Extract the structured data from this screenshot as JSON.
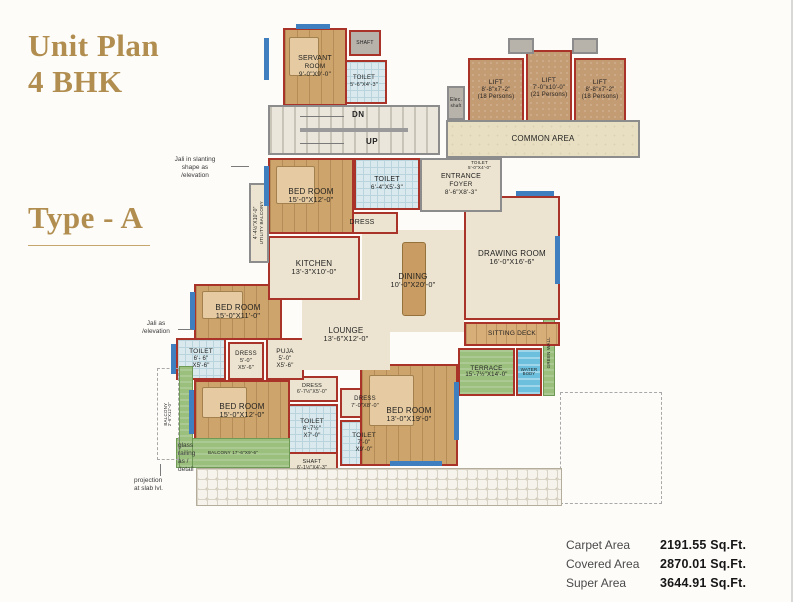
{
  "header": {
    "title_line1": "Unit Plan",
    "title_line2": "4 BHK",
    "type_label": "Type - A"
  },
  "stats": {
    "rows": [
      {
        "label": "Carpet Area",
        "value": "2191.55 Sq.Ft."
      },
      {
        "label": "Covered Area",
        "value": "2870.01 Sq.Ft."
      },
      {
        "label": "Super Area",
        "value": "3644.91 Sq.Ft."
      }
    ]
  },
  "colors": {
    "title_gold": "#b18e50",
    "wall_red": "#a93229",
    "wall_gray": "#8c8c8c",
    "window_blue": "#3f7fbf",
    "terrace_green": "#9bbf7d",
    "water_blue": "#6cc0dd"
  },
  "plan": {
    "stair_dn": "DN",
    "stair_up": "UP",
    "rooms": [
      {
        "id": "paver-strip",
        "x": 196,
        "y": 468,
        "w": 366,
        "h": 38,
        "fill": "paver",
        "border": "thin",
        "lines": []
      },
      {
        "id": "projection-dashed-outline",
        "x": 560,
        "y": 392,
        "w": 102,
        "h": 112,
        "fill": "none",
        "border": "dashed",
        "lines": []
      },
      {
        "id": "balcony-side",
        "x": 157,
        "y": 368,
        "w": 22,
        "h": 92,
        "fill": "none",
        "border": "dashed",
        "vertical": true,
        "size": 4.5,
        "lines": [
          "BALCONY",
          "2'-6\"X12'-0\""
        ]
      },
      {
        "id": "green-strip-left",
        "x": 179,
        "y": 366,
        "w": 14,
        "h": 102,
        "fill": "green",
        "border": "green",
        "lines": []
      },
      {
        "id": "balcony-bottom",
        "x": 176,
        "y": 438,
        "w": 114,
        "h": 30,
        "fill": "green",
        "border": "green",
        "size": 4.5,
        "lines": [
          "BALCONY 17'-6\"X9'-6\""
        ]
      },
      {
        "id": "stairs",
        "x": 268,
        "y": 105,
        "w": 172,
        "h": 50,
        "fill": "stair",
        "border": "gray",
        "deco": "stairs",
        "lines": []
      },
      {
        "id": "common-area",
        "x": 446,
        "y": 120,
        "w": 194,
        "h": 38,
        "fill": "common",
        "border": "gray",
        "size": 8,
        "lines": [
          "COMMON AREA"
        ]
      },
      {
        "id": "lift-shaft-a",
        "x": 508,
        "y": 38,
        "w": 26,
        "h": 16,
        "fill": "grayfill",
        "border": "gray",
        "lines": []
      },
      {
        "id": "lift-shaft-b",
        "x": 572,
        "y": 38,
        "w": 26,
        "h": 16,
        "fill": "grayfill",
        "border": "gray",
        "lines": []
      },
      {
        "id": "lift-1",
        "x": 468,
        "y": 58,
        "w": 56,
        "h": 64,
        "fill": "lift",
        "border": "red",
        "size": 6.5,
        "lines": [
          "LIFT",
          "8'-8\"x7'-2\"",
          "(18 Persons)"
        ]
      },
      {
        "id": "lift-2",
        "x": 526,
        "y": 50,
        "w": 46,
        "h": 76,
        "fill": "lift",
        "border": "red",
        "size": 6.5,
        "lines": [
          "LIFT",
          "7'-0\"x10'-0\"",
          "(21 Persons)"
        ]
      },
      {
        "id": "lift-3",
        "x": 574,
        "y": 58,
        "w": 52,
        "h": 64,
        "fill": "lift",
        "border": "red",
        "size": 6.5,
        "lines": [
          "LIFT",
          "8'-8\"x7'-2\"",
          "(18 Persons)"
        ]
      },
      {
        "id": "elec-shaft",
        "x": 447,
        "y": 86,
        "w": 18,
        "h": 34,
        "fill": "grayfill",
        "border": "gray",
        "size": 5,
        "lines": [
          "Elec.",
          "shaft"
        ]
      },
      {
        "id": "servant-room",
        "x": 283,
        "y": 28,
        "w": 64,
        "h": 78,
        "fill": "wood",
        "border": "red",
        "size": 7,
        "deco": "bed",
        "lines": [
          "SERVANT",
          "ROOM",
          "9'-0\"X9'-0\""
        ]
      },
      {
        "id": "servant-shaft",
        "x": 349,
        "y": 30,
        "w": 32,
        "h": 26,
        "fill": "grayfill",
        "border": "red",
        "size": 5,
        "lines": [
          "SHAFT"
        ]
      },
      {
        "id": "servant-toilet",
        "x": 341,
        "y": 60,
        "w": 46,
        "h": 44,
        "fill": "tile",
        "border": "red",
        "size": 6,
        "lines": [
          "TOILET",
          "5'-6\"X4'-3\""
        ]
      },
      {
        "id": "utility-balcony",
        "x": 249,
        "y": 183,
        "w": 20,
        "h": 80,
        "fill": "beige",
        "border": "gray",
        "vertical": true,
        "size": 5,
        "lines": [
          "4'-4½\"X10'-0\"",
          "UTILITY BALCONY"
        ]
      },
      {
        "id": "bedroom-1",
        "x": 268,
        "y": 158,
        "w": 86,
        "h": 76,
        "fill": "wood",
        "border": "red",
        "size": 8,
        "deco": "bed",
        "lines": [
          "BED ROOM",
          "15'-0\"X12'-0\""
        ]
      },
      {
        "id": "toilet-1",
        "x": 354,
        "y": 158,
        "w": 66,
        "h": 52,
        "fill": "tile",
        "border": "red",
        "size": 7,
        "lines": [
          "TOILET",
          "6'-4\"X5'-3\""
        ]
      },
      {
        "id": "dress-1",
        "x": 326,
        "y": 212,
        "w": 72,
        "h": 22,
        "fill": "beige",
        "border": "red",
        "size": 7,
        "lines": [
          "DRESS"
        ]
      },
      {
        "id": "kitchen",
        "x": 268,
        "y": 236,
        "w": 92,
        "h": 64,
        "fill": "beige",
        "border": "red",
        "size": 8,
        "lines": [
          "KITCHEN",
          "13'-3\"X10'-0\""
        ]
      },
      {
        "id": "entrance-foyer",
        "x": 420,
        "y": 158,
        "w": 82,
        "h": 54,
        "fill": "beige",
        "border": "gray",
        "size": 7,
        "lines": [
          "ENTRANCE",
          "FOYER",
          "8'-6\"X8'-3\""
        ]
      },
      {
        "id": "powder-toilet",
        "x": 457,
        "y": 152,
        "w": 45,
        "h": 26,
        "fill": "tile",
        "border": "red",
        "size": 4.5,
        "lines": [
          "TOILET 5'-0\"X4'-0\""
        ]
      },
      {
        "id": "dining",
        "x": 362,
        "y": 230,
        "w": 102,
        "h": 102,
        "fill": "beige",
        "border": "none",
        "size": 8,
        "deco": "table",
        "lines": [
          "DINING",
          "10'-0\"X20'-0\""
        ]
      },
      {
        "id": "drawing-room",
        "x": 464,
        "y": 196,
        "w": 96,
        "h": 124,
        "fill": "beige",
        "border": "red",
        "size": 8,
        "lines": [
          "DRAWING ROOM",
          "16'-0\"X16'-6\""
        ]
      },
      {
        "id": "lounge",
        "x": 302,
        "y": 300,
        "w": 88,
        "h": 70,
        "fill": "beige",
        "border": "none",
        "size": 8,
        "lines": [
          "LOUNGE",
          "13'-6\"X12'-0\""
        ]
      },
      {
        "id": "sitting-deck",
        "x": 464,
        "y": 322,
        "w": 96,
        "h": 24,
        "fill": "deck",
        "border": "red",
        "size": 6.5,
        "lines": [
          "SITTING DECK"
        ]
      },
      {
        "id": "terrace",
        "x": 458,
        "y": 348,
        "w": 57,
        "h": 48,
        "fill": "green",
        "border": "red",
        "size": 6.5,
        "lines": [
          "TERRACE",
          "15'-7½\"X14'-0\""
        ]
      },
      {
        "id": "water-body",
        "x": 516,
        "y": 348,
        "w": 26,
        "h": 48,
        "fill": "water",
        "border": "red",
        "size": 4.5,
        "lines": [
          "WATER",
          "BODY"
        ]
      },
      {
        "id": "green-wall",
        "x": 543,
        "y": 310,
        "w": 12,
        "h": 86,
        "fill": "green",
        "border": "green",
        "vertical": true,
        "size": 4.5,
        "lines": [
          "GREEN WALL"
        ]
      },
      {
        "id": "bedroom-2",
        "x": 194,
        "y": 284,
        "w": 88,
        "h": 56,
        "fill": "wood",
        "border": "red",
        "size": 8,
        "deco": "bed",
        "lines": [
          "BED ROOM",
          "15'-0\"X11'-0\""
        ]
      },
      {
        "id": "toilet-2",
        "x": 176,
        "y": 338,
        "w": 50,
        "h": 42,
        "fill": "tile",
        "border": "red",
        "size": 6.5,
        "lines": [
          "TOILET",
          "6'- 6\"",
          "X5'-6\""
        ]
      },
      {
        "id": "dress-2",
        "x": 228,
        "y": 342,
        "w": 36,
        "h": 38,
        "fill": "beige",
        "border": "red",
        "size": 6,
        "lines": [
          "DRESS",
          "5'-0\"",
          "X5'-6\""
        ]
      },
      {
        "id": "puja",
        "x": 266,
        "y": 338,
        "w": 38,
        "h": 42,
        "fill": "beige",
        "border": "red",
        "size": 6.5,
        "lines": [
          "PUJA",
          "5'-0\"",
          "X5'-6\""
        ]
      },
      {
        "id": "bedroom-3",
        "x": 194,
        "y": 380,
        "w": 96,
        "h": 62,
        "fill": "wood",
        "border": "red",
        "size": 8,
        "deco": "bed",
        "lines": [
          "BED ROOM",
          "15'-0\"X12'-0\""
        ]
      },
      {
        "id": "bedroom-4",
        "x": 360,
        "y": 364,
        "w": 98,
        "h": 102,
        "fill": "wood",
        "border": "red",
        "size": 8,
        "deco": "bed",
        "lines": [
          "BED ROOM",
          "13'-0\"X19'-0\""
        ]
      },
      {
        "id": "dress-3",
        "x": 286,
        "y": 376,
        "w": 52,
        "h": 26,
        "fill": "beige",
        "border": "red",
        "size": 5.5,
        "lines": [
          "DRESS",
          "6'-7½\"X5'-0\""
        ]
      },
      {
        "id": "dress-4",
        "x": 340,
        "y": 388,
        "w": 50,
        "h": 30,
        "fill": "beige",
        "border": "red",
        "size": 6,
        "lines": [
          "DRESS",
          "7'-0\"X8'-0\""
        ]
      },
      {
        "id": "toilet-3",
        "x": 286,
        "y": 404,
        "w": 52,
        "h": 50,
        "fill": "tile",
        "border": "red",
        "size": 6.5,
        "lines": [
          "TOILET",
          "6'-7½\"",
          "X7'-0\""
        ]
      },
      {
        "id": "toilet-4",
        "x": 340,
        "y": 420,
        "w": 48,
        "h": 46,
        "fill": "tile",
        "border": "red",
        "size": 6.5,
        "lines": [
          "TOILET",
          "7'-0\"",
          "X9'-0\""
        ]
      },
      {
        "id": "shaft-2",
        "x": 286,
        "y": 452,
        "w": 52,
        "h": 26,
        "fill": "beige",
        "border": "red",
        "size": 5.5,
        "lines": [
          "SHAFT",
          "6'-1½\"X4'-3\""
        ]
      }
    ],
    "windows": [
      {
        "x": 264,
        "y": 38,
        "w": 5,
        "h": 42
      },
      {
        "x": 296,
        "y": 24,
        "w": 34,
        "h": 5
      },
      {
        "x": 264,
        "y": 166,
        "w": 5,
        "h": 40
      },
      {
        "x": 190,
        "y": 292,
        "w": 5,
        "h": 38
      },
      {
        "x": 171,
        "y": 344,
        "w": 5,
        "h": 30
      },
      {
        "x": 189,
        "y": 390,
        "w": 5,
        "h": 44
      },
      {
        "x": 516,
        "y": 191,
        "w": 38,
        "h": 5
      },
      {
        "x": 555,
        "y": 236,
        "w": 5,
        "h": 48
      },
      {
        "x": 454,
        "y": 382,
        "w": 5,
        "h": 58
      },
      {
        "x": 390,
        "y": 461,
        "w": 52,
        "h": 5
      }
    ],
    "annotations": [
      {
        "id": "jali-slanting-note",
        "x": 160,
        "y": 156,
        "w": 70,
        "align": "center",
        "size": 6.5,
        "lines": [
          "Jali in slanting",
          "shape as",
          "/elevation"
        ]
      },
      {
        "id": "jali-note",
        "x": 134,
        "y": 320,
        "w": 44,
        "align": "center",
        "size": 6.5,
        "lines": [
          "Jali as",
          "/elevation"
        ]
      },
      {
        "id": "glass-railing-note",
        "x": 178,
        "y": 442,
        "w": 38,
        "align": "left",
        "size": 6.5,
        "lines": [
          "glass",
          "railing",
          "as /",
          "detail"
        ]
      },
      {
        "id": "projection-note",
        "x": 134,
        "y": 477,
        "w": 56,
        "align": "left",
        "size": 6.5,
        "lines": [
          "projection",
          "at slab lvl."
        ]
      }
    ],
    "leaders": [
      {
        "x": 231,
        "y": 166,
        "w": 18,
        "h": 1
      },
      {
        "x": 178,
        "y": 329,
        "w": 14,
        "h": 1
      },
      {
        "x": 300,
        "y": 116,
        "w": 44,
        "h": 1
      },
      {
        "x": 300,
        "y": 143,
        "w": 44,
        "h": 1
      },
      {
        "x": 160,
        "y": 464,
        "w": 1,
        "h": 12
      }
    ]
  }
}
